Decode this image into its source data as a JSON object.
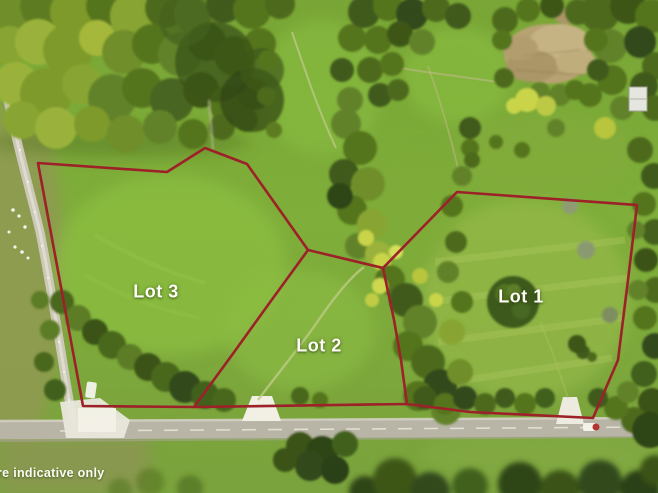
{
  "image": {
    "width": 658,
    "height": 493,
    "description": "Aerial drone photograph of three grassy rural lots outlined in red, bordered by a sealed road at the bottom and a gravel side road on the left, with dense tree belts and a tan earth mound at the top"
  },
  "overlay": {
    "labels": [
      {
        "id": "lot-3",
        "text": "Lot 3",
        "x": 156,
        "y": 292
      },
      {
        "id": "lot-2",
        "text": "Lot 2",
        "x": 319,
        "y": 346
      },
      {
        "id": "lot-1",
        "text": "Lot 1",
        "x": 521,
        "y": 297
      }
    ],
    "disclaimer": {
      "text": "re indicative only",
      "x": -3,
      "y": 466
    },
    "boundary_color": "#9c2128",
    "boundaries": {
      "outer": [
        [
          38,
          163
        ],
        [
          167,
          172
        ],
        [
          205,
          148
        ],
        [
          247,
          164
        ],
        [
          308,
          250
        ],
        [
          383,
          268
        ],
        [
          457,
          192
        ],
        [
          637,
          205
        ],
        [
          628,
          280
        ],
        [
          618,
          360
        ],
        [
          593,
          418
        ],
        [
          470,
          412
        ],
        [
          407,
          404
        ],
        [
          194,
          407
        ],
        [
          83,
          406
        ]
      ],
      "divider_lot3_lot2": [
        [
          308,
          250
        ],
        [
          268,
          305
        ],
        [
          232,
          355
        ],
        [
          194,
          407
        ]
      ],
      "divider_lot2_lot1": [
        [
          383,
          268
        ],
        [
          394,
          320
        ],
        [
          401,
          360
        ],
        [
          407,
          404
        ]
      ]
    }
  },
  "colors": {
    "boundary_red": "#9c2128",
    "label_white": "#fdfdf6",
    "grass_green": "#7dab38",
    "bright_grass": "#8cbd42",
    "forest_dark_green": "#33491a",
    "tree_mid_green": "#55741f",
    "dirt_tan": "#b7a272",
    "road_gray": "#b8b5a7",
    "driveway_white": "#f2f0e5"
  }
}
